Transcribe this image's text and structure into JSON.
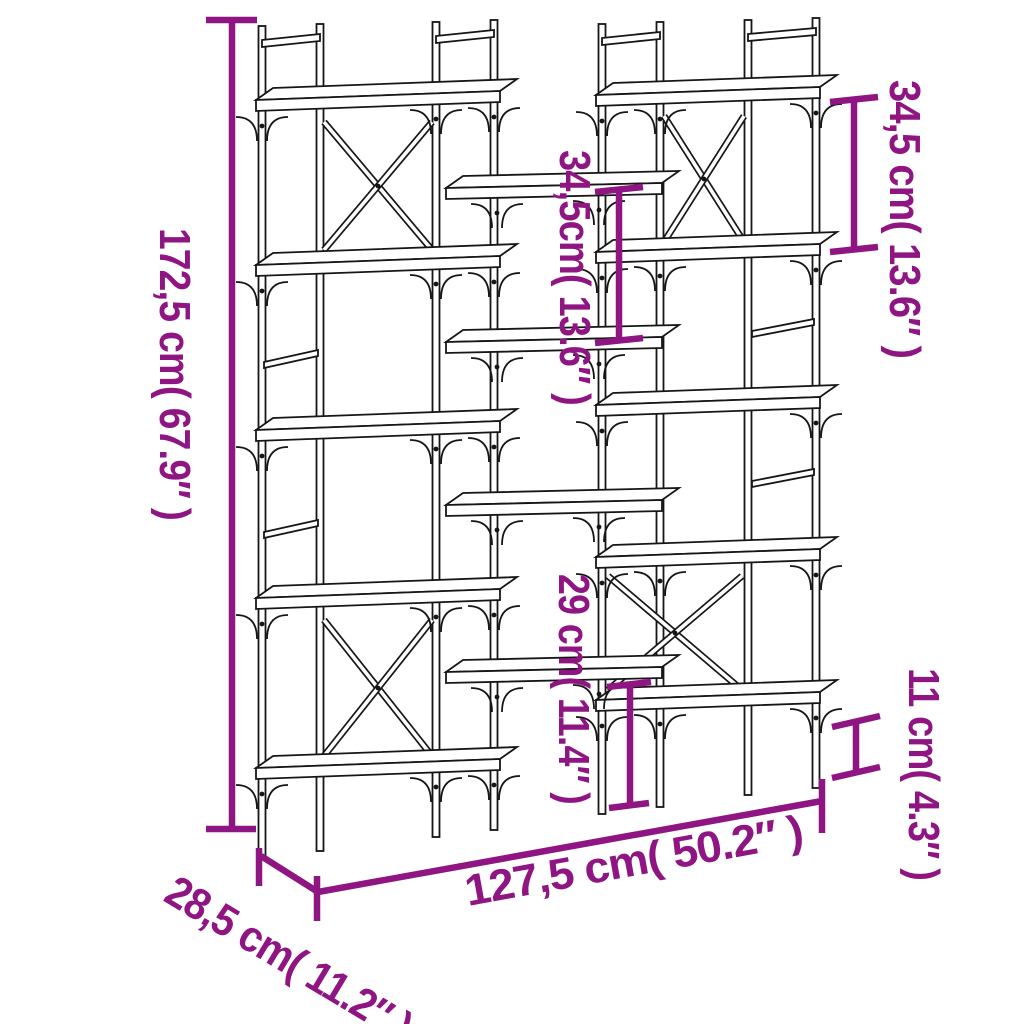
{
  "image": {
    "type": "product-dimension-diagram"
  },
  "colors": {
    "dimension_accent": "#8f1583",
    "line_art": "#161616",
    "background": "#ffffff"
  },
  "dimensions": {
    "height": {
      "label": "172,5 cm( 67.9″ )",
      "cm": "172,5",
      "inch": "67.9"
    },
    "width": {
      "label": "127,5 cm( 50.2″ )",
      "cm": "127,5",
      "inch": "50.2"
    },
    "depth": {
      "label": "28,5 cm( 11.2″ )",
      "cm": "28,5",
      "inch": "11.2"
    },
    "upper_right_shelf_spacing": {
      "label": "34,5 cm( 13.6″ )",
      "cm": "34,5",
      "inch": "13.6"
    },
    "middle_shelf_spacing": {
      "label": "34,5cm( 13.6″ )",
      "cm": "34,5",
      "inch": "13.6"
    },
    "lower_middle_clearance": {
      "label": "29 cm( 11.4″ )",
      "cm": "29",
      "inch": "11.4"
    },
    "bottom_clearance": {
      "label": "11 cm( 4.3″ )",
      "cm": "11",
      "inch": "4.3"
    }
  }
}
